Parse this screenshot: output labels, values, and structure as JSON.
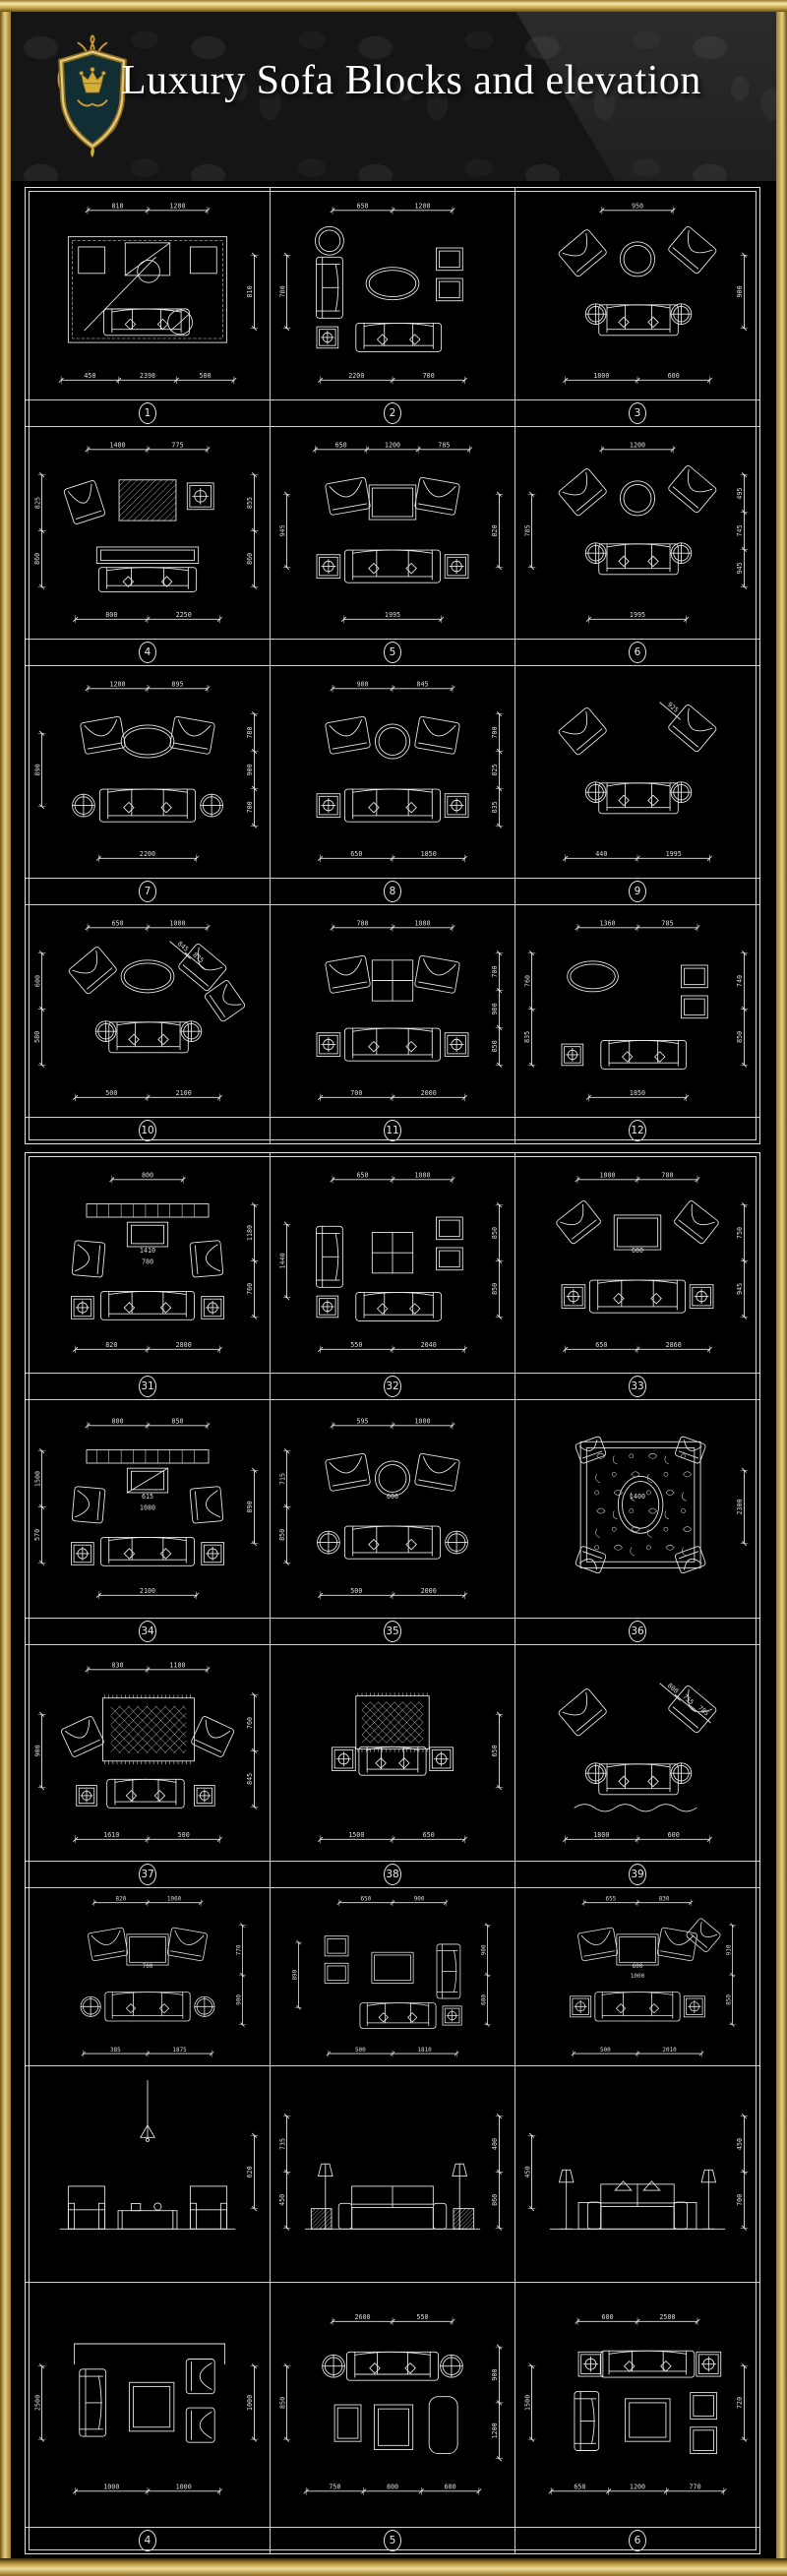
{
  "header": {
    "title": "Luxury Sofa Blocks and elevation",
    "logo": "heraldic-crest-shield-with-crown"
  },
  "colors": {
    "gold": "#c9a245",
    "gold_light": "#f0dd9a",
    "gold_dark": "#6e5414",
    "cad_line": "#e8e8e8",
    "background": "#000000",
    "header_background": "#151515",
    "shield_teal": "#102e33",
    "title_text": "#ffffff"
  },
  "panels": [
    {
      "name": "sheet-1",
      "rows": [
        {
          "labels": [
            "1",
            "2",
            "3"
          ],
          "cells": [
            {
              "variant": "room",
              "dims": {
                "top": [
                  "810",
                  "1200"
                ],
                "right": [
                  "810"
                ],
                "bottom": [
                  "450",
                  "2398",
                  "500"
                ]
              }
            },
            {
              "variant": "col",
              "opts": {
                "top_chair": true,
                "table": "oval"
              },
              "dims": {
                "top": [
                  "650",
                  "1200"
                ],
                "left": [
                  "780"
                ],
                "bottom": [
                  "2200",
                  "700"
                ]
              }
            },
            {
              "variant": "diag",
              "opts": {
                "table": "round"
              },
              "dims": {
                "top": [
                  "950"
                ],
                "right": [
                  "900"
                ],
                "bottom": [
                  "1800",
                  "600"
                ]
              }
            }
          ]
        },
        {
          "labels": [
            "4",
            "5",
            "6"
          ],
          "cells": [
            {
              "variant": "tvrug",
              "dims": {
                "top": [
                  "1400",
                  "775"
                ],
                "left": [
                  "825",
                  "860"
                ],
                "right": [
                  "855",
                  "860"
                ],
                "bottom": [
                  "800",
                  "2250"
                ]
              }
            },
            {
              "variant": "set",
              "opts": {
                "table": "rect",
                "chairs": "pair",
                "sides": "sq"
              },
              "dims": {
                "top": [
                  "650",
                  "1200",
                  "785"
                ],
                "left": [
                  "945"
                ],
                "right": [
                  "820"
                ],
                "bottom": [
                  "1995"
                ]
              }
            },
            {
              "variant": "diag",
              "opts": {
                "table": "round"
              },
              "dims": {
                "top": [
                  "1200"
                ],
                "left": [
                  "785"
                ],
                "right": [
                  "495",
                  "745",
                  "945"
                ],
                "bottom": [
                  "1995"
                ]
              }
            }
          ]
        },
        {
          "labels": [
            "7",
            "8",
            "9"
          ],
          "cells": [
            {
              "variant": "set",
              "opts": {
                "table": "oval",
                "chairs": "pair",
                "sides": "round"
              },
              "dims": {
                "top": [
                  "1200",
                  "895"
                ],
                "left": [
                  "890"
                ],
                "right": [
                  "780",
                  "900",
                  "700"
                ],
                "bottom": [
                  "2200"
                ]
              }
            },
            {
              "variant": "set",
              "opts": {
                "table": "round",
                "chairs": "pair",
                "sides": "sq"
              },
              "dims": {
                "top": [
                  "900",
                  "845"
                ],
                "right": [
                  "700",
                  "825",
                  "835"
                ],
                "bottom": [
                  "650",
                  "1850"
                ]
              }
            },
            {
              "variant": "diag",
              "opts": {},
              "dims": {
                "diag": [
                  "925"
                ],
                "bottom": [
                  "440",
                  "1995"
                ]
              }
            }
          ]
        },
        {
          "labels": [
            "10",
            "11",
            "12"
          ],
          "cells": [
            {
              "variant": "diag",
              "opts": {
                "table": "oval",
                "extra": true
              },
              "dims": {
                "top": [
                  "650",
                  "1000"
                ],
                "left": [
                  "600",
                  "580"
                ],
                "diag": [
                  "845",
                  "875"
                ],
                "bottom": [
                  "500",
                  "2100"
                ]
              }
            },
            {
              "variant": "set",
              "opts": {
                "table": "grid",
                "chairs": "pair",
                "sides": "sq"
              },
              "dims": {
                "top": [
                  "780",
                  "1000"
                ],
                "right": [
                  "700",
                  "980",
                  "850"
                ],
                "bottom": [
                  "700",
                  "2000"
                ]
              }
            },
            {
              "variant": "col",
              "opts": {
                "no_vsofa": true,
                "table": "none"
              },
              "dims": {
                "top": [
                  "1360",
                  "785"
                ],
                "left": [
                  "760",
                  "835"
                ],
                "right": [
                  "740",
                  "850"
                ],
                "bottom": [
                  "1850"
                ]
              }
            }
          ]
        }
      ]
    },
    {
      "name": "sheet-2",
      "rows": [
        {
          "labels": [
            "31",
            "32",
            "33"
          ],
          "cells": [
            {
              "variant": "tv",
              "opts": {},
              "dims": {
                "top": [
                  "800"
                ],
                "mid": [
                  "1410",
                  "780"
                ],
                "right": [
                  "1180",
                  "760"
                ],
                "bottom": [
                  "820",
                  "2800"
                ]
              }
            },
            {
              "variant": "col",
              "opts": {
                "table": "grid"
              },
              "dims": {
                "top": [
                  "650",
                  "1000"
                ],
                "left": [
                  "1440"
                ],
                "right": [
                  "850",
                  "850"
                ],
                "bottom": [
                  "550",
                  "2040"
                ]
              }
            },
            {
              "variant": "set",
              "opts": {
                "table": "rect",
                "chairs": "corner",
                "sides": "sq"
              },
              "dims": {
                "top": [
                  "1000",
                  "780"
                ],
                "mid": [
                  "600"
                ],
                "right": [
                  "750",
                  "945"
                ],
                "bottom": [
                  "650",
                  "2860"
                ]
              }
            }
          ]
        },
        {
          "labels": [
            "34",
            "35",
            "36"
          ],
          "cells": [
            {
              "variant": "tv",
              "opts": {
                "tv2": true
              },
              "dims": {
                "top": [
                  "800",
                  "850"
                ],
                "left": [
                  "1500",
                  "570"
                ],
                "mid": [
                  "615",
                  "1080"
                ],
                "right": [
                  "890"
                ],
                "bottom": [
                  "2100"
                ]
              }
            },
            {
              "variant": "set",
              "opts": {
                "table": "round",
                "chairs": "pair",
                "sides": "round"
              },
              "dims": {
                "top": [
                  "595",
                  "1000"
                ],
                "mid": [
                  "600"
                ],
                "left": [
                  "715",
                  "850"
                ],
                "bottom": [
                  "500",
                  "2000"
                ]
              }
            },
            {
              "variant": "rug",
              "opts": {},
              "dims": {
                "mid": [
                  "1400"
                ],
                "right": [
                  "2300"
                ]
              }
            }
          ]
        },
        {
          "labels": [
            "37",
            "38",
            "39"
          ],
          "cells": [
            {
              "variant": "rugset",
              "dims": {
                "top": [
                  "830",
                  "1180"
                ],
                "left": [
                  "900"
                ],
                "right": [
                  "760",
                  "845"
                ],
                "bottom": [
                  "1610",
                  "500"
                ]
              }
            },
            {
              "variant": "rugsofa",
              "dims": {
                "right": [
                  "650"
                ],
                "bottom": [
                  "1500",
                  "650"
                ]
              }
            },
            {
              "variant": "diag",
              "opts": {
                "wave": true
              },
              "dims": {
                "diag": [
                  "800",
                  "755",
                  "785"
                ],
                "bottom": [
                  "1800",
                  "600"
                ]
              }
            }
          ]
        },
        {
          "labels": null,
          "cells": [
            {
              "variant": "set",
              "opts": {
                "table": "rect",
                "chairs": "pair",
                "sides": "round"
              },
              "dims": {
                "top": [
                  "820",
                  "1060"
                ],
                "mid": [
                  "700"
                ],
                "right": [
                  "770",
                  "900"
                ],
                "bottom": [
                  "385",
                  "1875"
                ]
              }
            },
            {
              "variant": "col",
              "opts": {
                "mirror": true,
                "table": "rect"
              },
              "dims": {
                "top": [
                  "650",
                  "900"
                ],
                "left": [
                  "890"
                ],
                "right": [
                  "900",
                  "600"
                ],
                "bottom": [
                  "500",
                  "1810"
                ]
              }
            },
            {
              "variant": "set",
              "opts": {
                "table": "rect",
                "chairs": "pair",
                "sides": "sq",
                "diagchair": true
              },
              "dims": {
                "top": [
                  "655",
                  "830"
                ],
                "mid": [
                  "600",
                  "1000"
                ],
                "right": [
                  "910",
                  "850"
                ],
                "bottom": [
                  "500",
                  "2010"
                ]
              }
            }
          ]
        },
        {
          "labels": null,
          "cells": [
            {
              "variant": "elev",
              "opts": {
                "style": "chand"
              },
              "dims": {
                "right": [
                  "620"
                ]
              }
            },
            {
              "variant": "elev",
              "opts": {
                "style": "lamps"
              },
              "dims": {
                "left": [
                  "735",
                  "450"
                ],
                "right": [
                  "400",
                  "860"
                ]
              }
            },
            {
              "variant": "elev",
              "opts": {
                "style": "pillows"
              },
              "dims": {
                "left": [
                  "450"
                ],
                "right": [
                  "450",
                  "700"
                ]
              }
            }
          ]
        },
        {
          "labels": [
            "4",
            "5",
            "6"
          ],
          "cells": [
            {
              "variant": "corner",
              "dims": {
                "left": [
                  "2500"
                ],
                "right": [
                  "1000"
                ],
                "bottom": [
                  "1000",
                  "1000"
                ]
              }
            },
            {
              "variant": "b5",
              "dims": {
                "top": [
                  "2600",
                  "550"
                ],
                "left": [
                  "850"
                ],
                "right": [
                  "900",
                  "1200"
                ],
                "bottom": [
                  "750",
                  "800",
                  "600"
                ]
              }
            },
            {
              "variant": "b6",
              "dims": {
                "top": [
                  "600",
                  "2500"
                ],
                "left": [
                  "1500"
                ],
                "right": [
                  "720"
                ],
                "bottom": [
                  "650",
                  "1200",
                  "770"
                ]
              }
            }
          ]
        }
      ]
    }
  ]
}
